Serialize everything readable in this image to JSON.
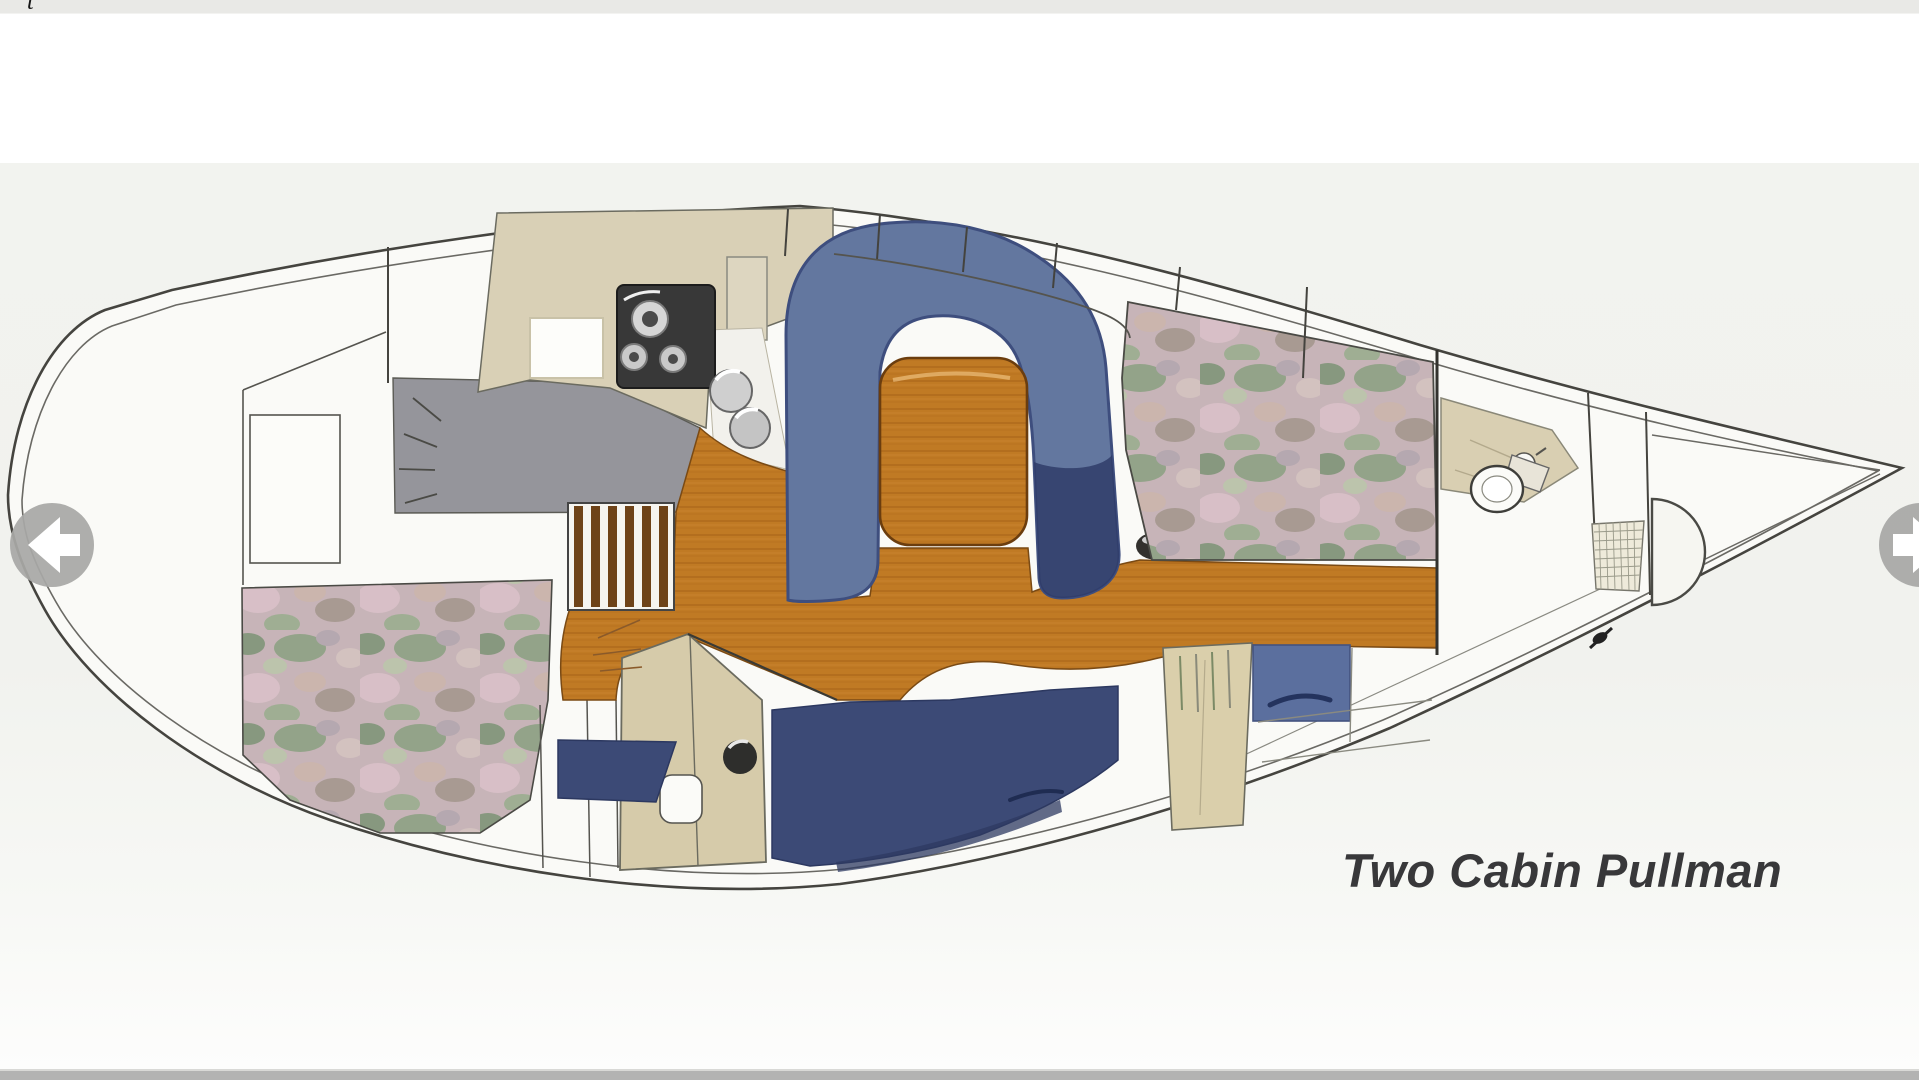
{
  "caption": {
    "text": "Two Cabin Pullman"
  },
  "header_fragment": {
    "text": "t"
  },
  "carousel": {
    "prev_icon": "left-arrow-icon",
    "next_icon": "right-arrow-icon"
  },
  "plan": {
    "name": "sailboat-interior-floor-plan",
    "colors": {
      "hull_fill": "#fafaf7",
      "outline": "#45443f",
      "wood_sole": "#c07a24",
      "table_wood": "#c8812a",
      "dinette_blue": "#63779f",
      "dinette_shadow_navy": "#2f3c68",
      "settee_navy": "#3c4a76",
      "berth_fabric_base": "#c7b4b8",
      "galley_counter_beige": "#d9d0b6",
      "galley_gray": "#95959b",
      "stove_dark": "#383838",
      "louver_tan": "#dacfab",
      "arrow_gray": "#a8a8a6"
    }
  }
}
